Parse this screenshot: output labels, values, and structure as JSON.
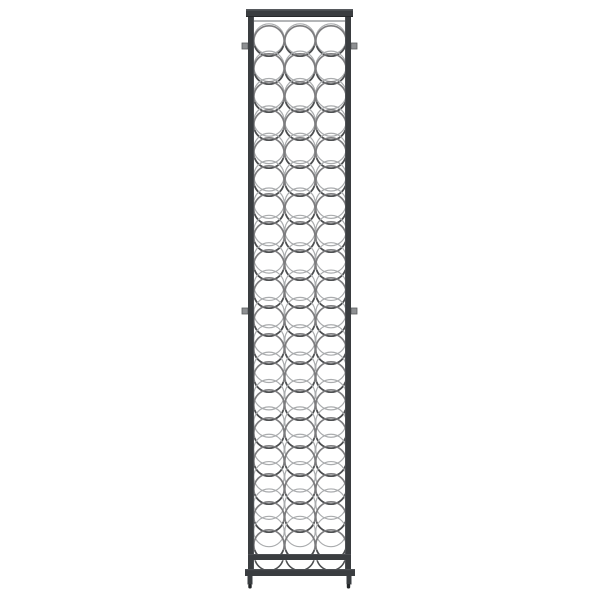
{
  "scene": {
    "type": "product-photo",
    "description": "Tall narrow black metal wine bottle rack with three columns of circular bottle-holder rings, standing upright on a plain white background",
    "background_color": "#ffffff"
  },
  "rack": {
    "object": "wine-bottle-rack",
    "bottle_columns": 3,
    "full_ring_rows": 19,
    "partial_bottom_rows": 1,
    "mounting_pegs": 4,
    "colors": {
      "frame": "#3a3d40",
      "frame_highlight": "#56595d",
      "frame_shadow": "#27292b",
      "ring": "#7d7d7f",
      "ring_back": "#aaacae",
      "ring_shadow": "#4c4e50",
      "wire": "#b3b5b7",
      "peg": "#8e9092",
      "peg_border": "#5a5c5e",
      "feet": "#232527"
    },
    "geometry": {
      "canvas": {
        "w": 600,
        "h": 600
      },
      "frame": {
        "top_bar": {
          "x": 246,
          "y": 9,
          "w": 107,
          "h": 8
        },
        "left_post_x": 248,
        "right_post_x": 345,
        "post_w": 6,
        "post_top": 17,
        "post_bottom": 576,
        "mid_rail": {
          "x": 248,
          "y": 554,
          "w": 103,
          "h": 6
        },
        "bottom_bar": {
          "x": 245,
          "y": 569,
          "w": 110,
          "h": 7
        },
        "legs": {
          "left_x": 247.5,
          "right_x": 346.5,
          "y": 576,
          "w": 5,
          "h": 8.5
        },
        "feet": {
          "left_x": 248.3,
          "right_x": 346.8,
          "y": 584,
          "w": 3.4,
          "h": 4.5
        }
      },
      "top_wire": {
        "x": 254,
        "y": 20,
        "w": 91,
        "h": 2
      },
      "rings": {
        "columns_cx": [
          269,
          300,
          331
        ],
        "row0_cy": 41,
        "row_spacing": 28,
        "rows": 19,
        "radius": 15.2,
        "back_offset_min": 2,
        "back_offset_max": 13.5,
        "clip": {
          "x": 253.5,
          "y": 18,
          "w": 92,
          "h": 542
        }
      },
      "bottom_arcs": {
        "cy": 556,
        "r": 14.5,
        "clip": {
          "x": 253.5,
          "y": 559.5,
          "w": 92,
          "h": 12.5
        }
      },
      "pegs": [
        {
          "x": 242,
          "y": 43
        },
        {
          "x": 351,
          "y": 43
        },
        {
          "x": 242,
          "y": 308
        },
        {
          "x": 351,
          "y": 308
        }
      ],
      "peg_size": 6
    }
  }
}
